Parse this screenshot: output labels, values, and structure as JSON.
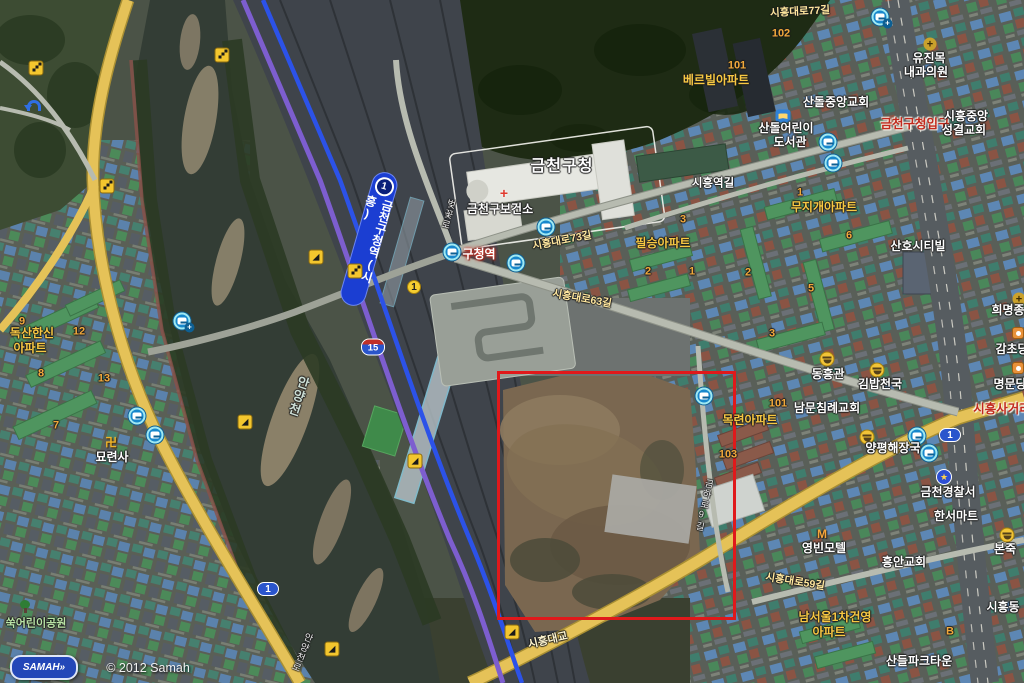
{
  "map": {
    "attribution": {
      "logo": "SAMAH»",
      "copyright": "© 2012 Samah"
    },
    "station_band": {
      "label": "금천구청역(시흥)",
      "line_badge": "1"
    },
    "highlight_box": {
      "x": 497,
      "y": 371,
      "w": 239,
      "h": 249,
      "color": "#e0191b",
      "stroke": 3
    },
    "colors": {
      "highlight_red": "#e0191b",
      "subway_line_blue": "#2c52e8",
      "rail_purple": "#7d5ecf",
      "major_road_yellow": "#e8c95c",
      "poi_orange": "#f7c843",
      "route_shield_blue": "#2a55cc"
    },
    "labels": [
      {
        "text": "시흥대로77길",
        "x": 800,
        "y": 12,
        "cls": "road",
        "rot": -3
      },
      {
        "text": "102",
        "x": 781,
        "y": 34,
        "cls": "num"
      },
      {
        "text": "101",
        "x": 737,
        "y": 66,
        "cls": "num"
      },
      {
        "text": "베르빌아파트",
        "x": 716,
        "y": 80,
        "cls": "apt"
      },
      {
        "text": "산돌중앙교회",
        "x": 836,
        "y": 102,
        "cls": "poi"
      },
      {
        "text": "산돌어린이",
        "x": 786,
        "y": 128,
        "cls": "poi"
      },
      {
        "text": "도서관",
        "x": 790,
        "y": 142,
        "cls": "poi"
      },
      {
        "text": "유진목",
        "x": 929,
        "y": 58,
        "cls": "poi"
      },
      {
        "text": "내과의원",
        "x": 926,
        "y": 72,
        "cls": "poi"
      },
      {
        "text": "금천구청입구",
        "x": 915,
        "y": 124,
        "cls": "red"
      },
      {
        "text": "시흥중앙",
        "x": 966,
        "y": 116,
        "cls": "poi"
      },
      {
        "text": "성결교회",
        "x": 964,
        "y": 130,
        "cls": "poi"
      },
      {
        "text": "금천구청",
        "x": 562,
        "y": 167,
        "cls": "gu"
      },
      {
        "text": "금천구보건소",
        "x": 500,
        "y": 209,
        "cls": "poi"
      },
      {
        "text": "시흥역길",
        "x": 713,
        "y": 184,
        "cls": "roadw"
      },
      {
        "text": "무지개아파트",
        "x": 824,
        "y": 207,
        "cls": "apt"
      },
      {
        "text": "1",
        "x": 800,
        "y": 193,
        "cls": "num"
      },
      {
        "text": "6",
        "x": 849,
        "y": 236,
        "cls": "num"
      },
      {
        "text": "2",
        "x": 748,
        "y": 273,
        "cls": "num"
      },
      {
        "text": "5",
        "x": 811,
        "y": 289,
        "cls": "num"
      },
      {
        "text": "3",
        "x": 772,
        "y": 334,
        "cls": "num"
      },
      {
        "text": "3",
        "x": 683,
        "y": 220,
        "cls": "num"
      },
      {
        "text": "1",
        "x": 692,
        "y": 272,
        "cls": "num"
      },
      {
        "text": "필승아파트",
        "x": 663,
        "y": 243,
        "cls": "apt"
      },
      {
        "text": "2",
        "x": 648,
        "y": 272,
        "cls": "num"
      },
      {
        "text": "산호시티빌",
        "x": 918,
        "y": 246,
        "cls": "poi"
      },
      {
        "text": "희명종",
        "x": 1008,
        "y": 310,
        "cls": "poi"
      },
      {
        "text": "감초당",
        "x": 1012,
        "y": 349,
        "cls": "poi"
      },
      {
        "text": "명문당",
        "x": 1010,
        "y": 384,
        "cls": "poi"
      },
      {
        "text": "시흥사거리",
        "x": 1002,
        "y": 409,
        "cls": "red"
      },
      {
        "text": "동흥관",
        "x": 828,
        "y": 374,
        "cls": "poi"
      },
      {
        "text": "김밥천국",
        "x": 880,
        "y": 384,
        "cls": "poi"
      },
      {
        "text": "남문침례교회",
        "x": 827,
        "y": 408,
        "cls": "poi"
      },
      {
        "text": "101",
        "x": 778,
        "y": 404,
        "cls": "num"
      },
      {
        "text": "목련아파트",
        "x": 750,
        "y": 420,
        "cls": "apt"
      },
      {
        "text": "103",
        "x": 728,
        "y": 455,
        "cls": "num"
      },
      {
        "text": "양평해장국",
        "x": 893,
        "y": 448,
        "cls": "poi"
      },
      {
        "text": "금천경찰서",
        "x": 948,
        "y": 492,
        "cls": "poi"
      },
      {
        "text": "한서마트",
        "x": 956,
        "y": 516,
        "cls": "poi"
      },
      {
        "text": "본죽",
        "x": 1005,
        "y": 549,
        "cls": "poi"
      },
      {
        "text": "흥안교회",
        "x": 904,
        "y": 562,
        "cls": "poi"
      },
      {
        "text": "영빈모텔",
        "x": 824,
        "y": 548,
        "cls": "poi"
      },
      {
        "text": "시흥대로59길",
        "x": 795,
        "y": 582,
        "cls": "road",
        "rot": 9
      },
      {
        "text": "남서울1차건영",
        "x": 835,
        "y": 617,
        "cls": "apt"
      },
      {
        "text": "아파트",
        "x": 829,
        "y": 632,
        "cls": "apt"
      },
      {
        "text": "B",
        "x": 950,
        "y": 632,
        "cls": "num"
      },
      {
        "text": "산들파크타운",
        "x": 919,
        "y": 661,
        "cls": "poi"
      },
      {
        "text": "시흥동",
        "x": 1003,
        "y": 607,
        "cls": "poi"
      },
      {
        "text": "독산한신",
        "x": 32,
        "y": 333,
        "cls": "apt"
      },
      {
        "text": "아파트",
        "x": 30,
        "y": 348,
        "cls": "apt"
      },
      {
        "text": "9",
        "x": 22,
        "y": 322,
        "cls": "num"
      },
      {
        "text": "12",
        "x": 79,
        "y": 332,
        "cls": "num"
      },
      {
        "text": "8",
        "x": 41,
        "y": 374,
        "cls": "num"
      },
      {
        "text": "13",
        "x": 104,
        "y": 379,
        "cls": "num"
      },
      {
        "text": "7",
        "x": 56,
        "y": 426,
        "cls": "num"
      },
      {
        "text": "묘련사",
        "x": 112,
        "y": 457,
        "cls": "poi"
      },
      {
        "text": "쑥어린이공원",
        "x": 36,
        "y": 624,
        "cls": "park"
      },
      {
        "text": "구청역",
        "x": 479,
        "y": 254,
        "cls": "busstop"
      },
      {
        "text": "시흥대로73길",
        "x": 562,
        "y": 241,
        "cls": "road",
        "rot": -11
      },
      {
        "text": "시흥대로63길",
        "x": 582,
        "y": 299,
        "cls": "road",
        "rot": 10
      },
      {
        "text": "시흥대교",
        "x": 548,
        "y": 641,
        "cls": "bridge",
        "rot": -13
      },
      {
        "text": "안양천",
        "x": 298,
        "y": 396,
        "cls": "river",
        "vert": true,
        "rot": 18
      },
      {
        "text": "안양천로",
        "x": 301,
        "y": 652,
        "cls": "roadw-sm",
        "vert": true,
        "rot": 22
      },
      {
        "text": "벚꽃로",
        "x": 447,
        "y": 214,
        "cls": "roadw-sm",
        "vert": true,
        "rot": 15
      },
      {
        "text": "금하로9길",
        "x": 703,
        "y": 505,
        "cls": "roadw-sm",
        "vert": true,
        "rot": 12
      }
    ],
    "icons": [
      {
        "type": "bus",
        "x": 546,
        "y": 227
      },
      {
        "type": "bus",
        "x": 452,
        "y": 252
      },
      {
        "type": "bus",
        "x": 516,
        "y": 263
      },
      {
        "type": "bus",
        "x": 828,
        "y": 142
      },
      {
        "type": "bus",
        "x": 833,
        "y": 163
      },
      {
        "type": "bus",
        "x": 704,
        "y": 396
      },
      {
        "type": "bus",
        "x": 917,
        "y": 436
      },
      {
        "type": "bus",
        "x": 929,
        "y": 453
      },
      {
        "type": "bus",
        "x": 137,
        "y": 416
      },
      {
        "type": "bus",
        "x": 155,
        "y": 435
      },
      {
        "type": "bus-plus",
        "x": 880,
        "y": 17,
        "glyph": "+"
      },
      {
        "type": "bus-plus",
        "x": 182,
        "y": 321,
        "glyph": "+"
      },
      {
        "type": "stairs",
        "x": 222,
        "y": 55
      },
      {
        "type": "stairs",
        "x": 36,
        "y": 68
      },
      {
        "type": "stairs",
        "x": 107,
        "y": 186
      },
      {
        "type": "stairs",
        "x": 355,
        "y": 271
      },
      {
        "type": "ramp",
        "x": 316,
        "y": 257,
        "glyph": "◢"
      },
      {
        "type": "ramp",
        "x": 245,
        "y": 422,
        "glyph": "◢"
      },
      {
        "type": "ramp",
        "x": 415,
        "y": 461,
        "glyph": "◢"
      },
      {
        "type": "ramp",
        "x": 512,
        "y": 632,
        "glyph": "◢"
      },
      {
        "type": "ramp",
        "x": 332,
        "y": 649,
        "glyph": "◢"
      },
      {
        "type": "uturn",
        "x": 32,
        "y": 106
      },
      {
        "type": "busnum",
        "x": 414,
        "y": 287,
        "glyph": "1"
      },
      {
        "type": "route1",
        "x": 268,
        "y": 589,
        "glyph": "1"
      },
      {
        "type": "route1",
        "x": 950,
        "y": 435,
        "glyph": "1"
      },
      {
        "type": "route15",
        "x": 373,
        "y": 347,
        "glyph": "15"
      },
      {
        "type": "police",
        "x": 944,
        "y": 477,
        "glyph": "★"
      },
      {
        "type": "temple",
        "x": 111,
        "y": 442,
        "glyph": "卍"
      },
      {
        "type": "book",
        "x": 783,
        "y": 116
      },
      {
        "type": "cross-red",
        "x": 504,
        "y": 193,
        "glyph": "+"
      },
      {
        "type": "cross-gold",
        "x": 930,
        "y": 44,
        "glyph": "+"
      },
      {
        "type": "cross-gold",
        "x": 1019,
        "y": 299,
        "glyph": "+"
      },
      {
        "type": "rest",
        "x": 827,
        "y": 359
      },
      {
        "type": "rest",
        "x": 877,
        "y": 370
      },
      {
        "type": "rest",
        "x": 867,
        "y": 437
      },
      {
        "type": "rest",
        "x": 1007,
        "y": 535
      },
      {
        "type": "motel",
        "x": 822,
        "y": 534,
        "glyph": "M"
      },
      {
        "type": "tree",
        "x": 25,
        "y": 607
      },
      {
        "type": "shop",
        "x": 1018,
        "y": 333
      },
      {
        "type": "shop",
        "x": 1018,
        "y": 368
      }
    ]
  }
}
